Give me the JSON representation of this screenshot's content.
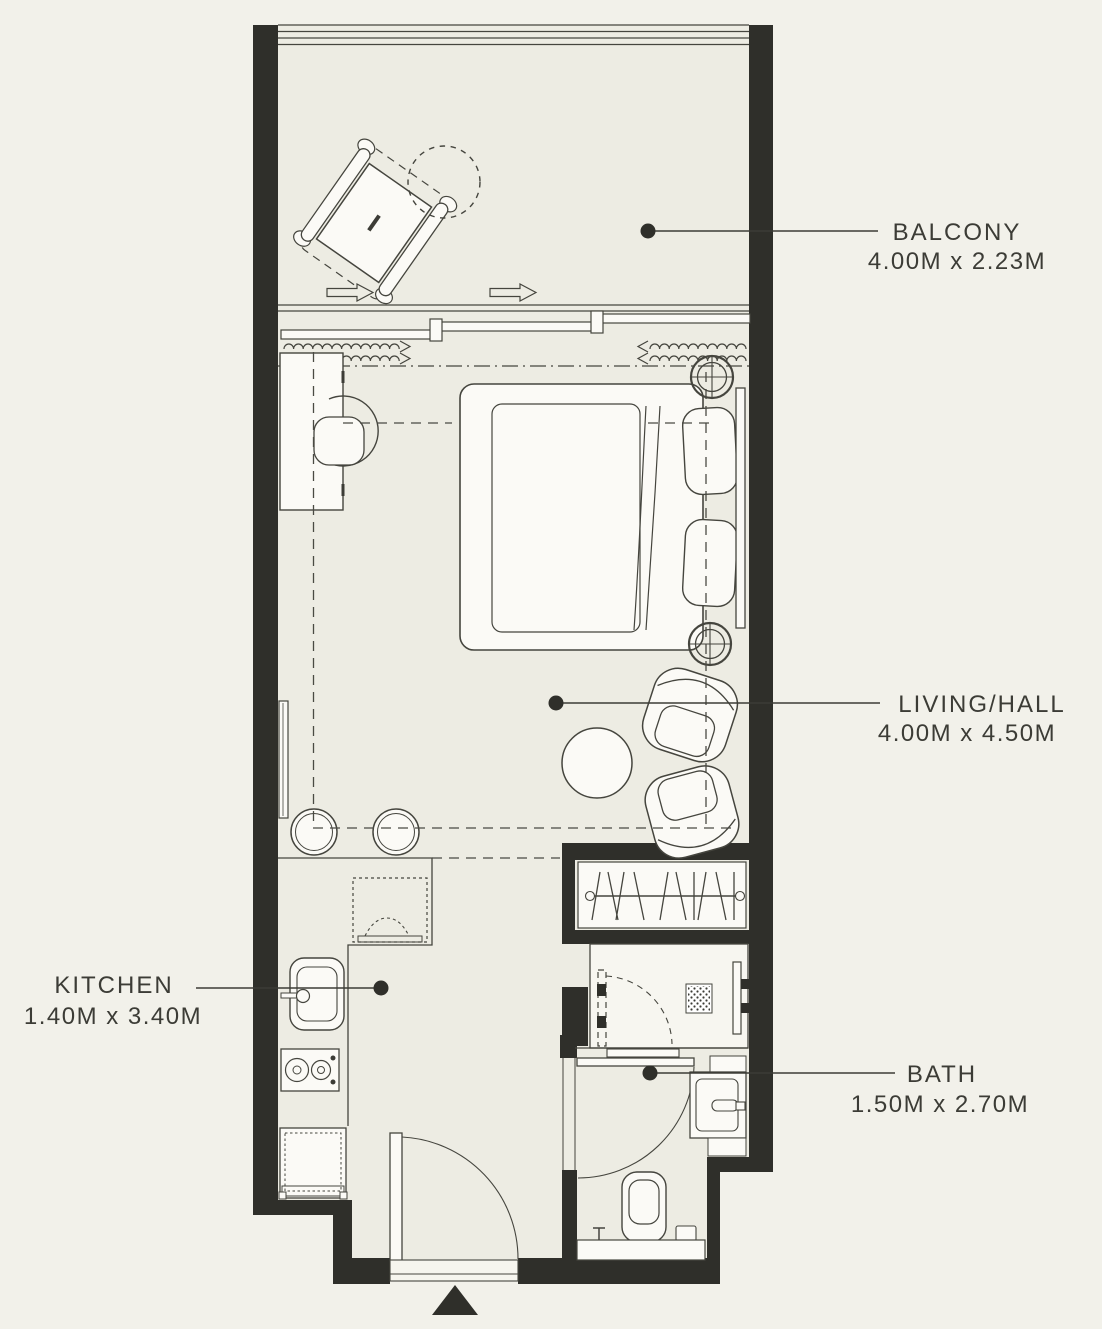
{
  "floor_plan": {
    "colors": {
      "background": "#f2f1ea",
      "wall": "#2f2f2a",
      "line": "#45453e",
      "text": "#3c3c36"
    },
    "rooms": [
      {
        "name": "BALCONY",
        "dimensions": "4.00M x 2.23M",
        "symbols": [
          "lounge-chair",
          "round-side-table",
          "sliding-door",
          "curtains",
          "direction-arrows",
          "leader-dot"
        ]
      },
      {
        "name": "LIVING/HALL",
        "dimensions": "4.00M x 4.50M",
        "symbols": [
          "double-bed",
          "pillows",
          "headboard",
          "ceiling-light",
          "desk",
          "desk-chair",
          "tv-panel",
          "wardrobe-rail",
          "clothes-hangers",
          "armchair",
          "coffee-table",
          "stool",
          "leader-dot"
        ]
      },
      {
        "name": "KITCHEN",
        "dimensions": "1.40M x 3.40M",
        "symbols": [
          "counter",
          "microwave",
          "sink",
          "cooktop",
          "refrigerator",
          "leader-dot"
        ]
      },
      {
        "name": "BATH",
        "dimensions": "1.50M x 2.70M",
        "symbols": [
          "shower",
          "shower-drain-mat",
          "glass-panel",
          "washbasin",
          "toilet",
          "swing-door",
          "leader-dot"
        ]
      }
    ],
    "entrance": {
      "symbols": [
        "entry-swing-door",
        "threshold",
        "entry-direction-triangle"
      ]
    }
  }
}
